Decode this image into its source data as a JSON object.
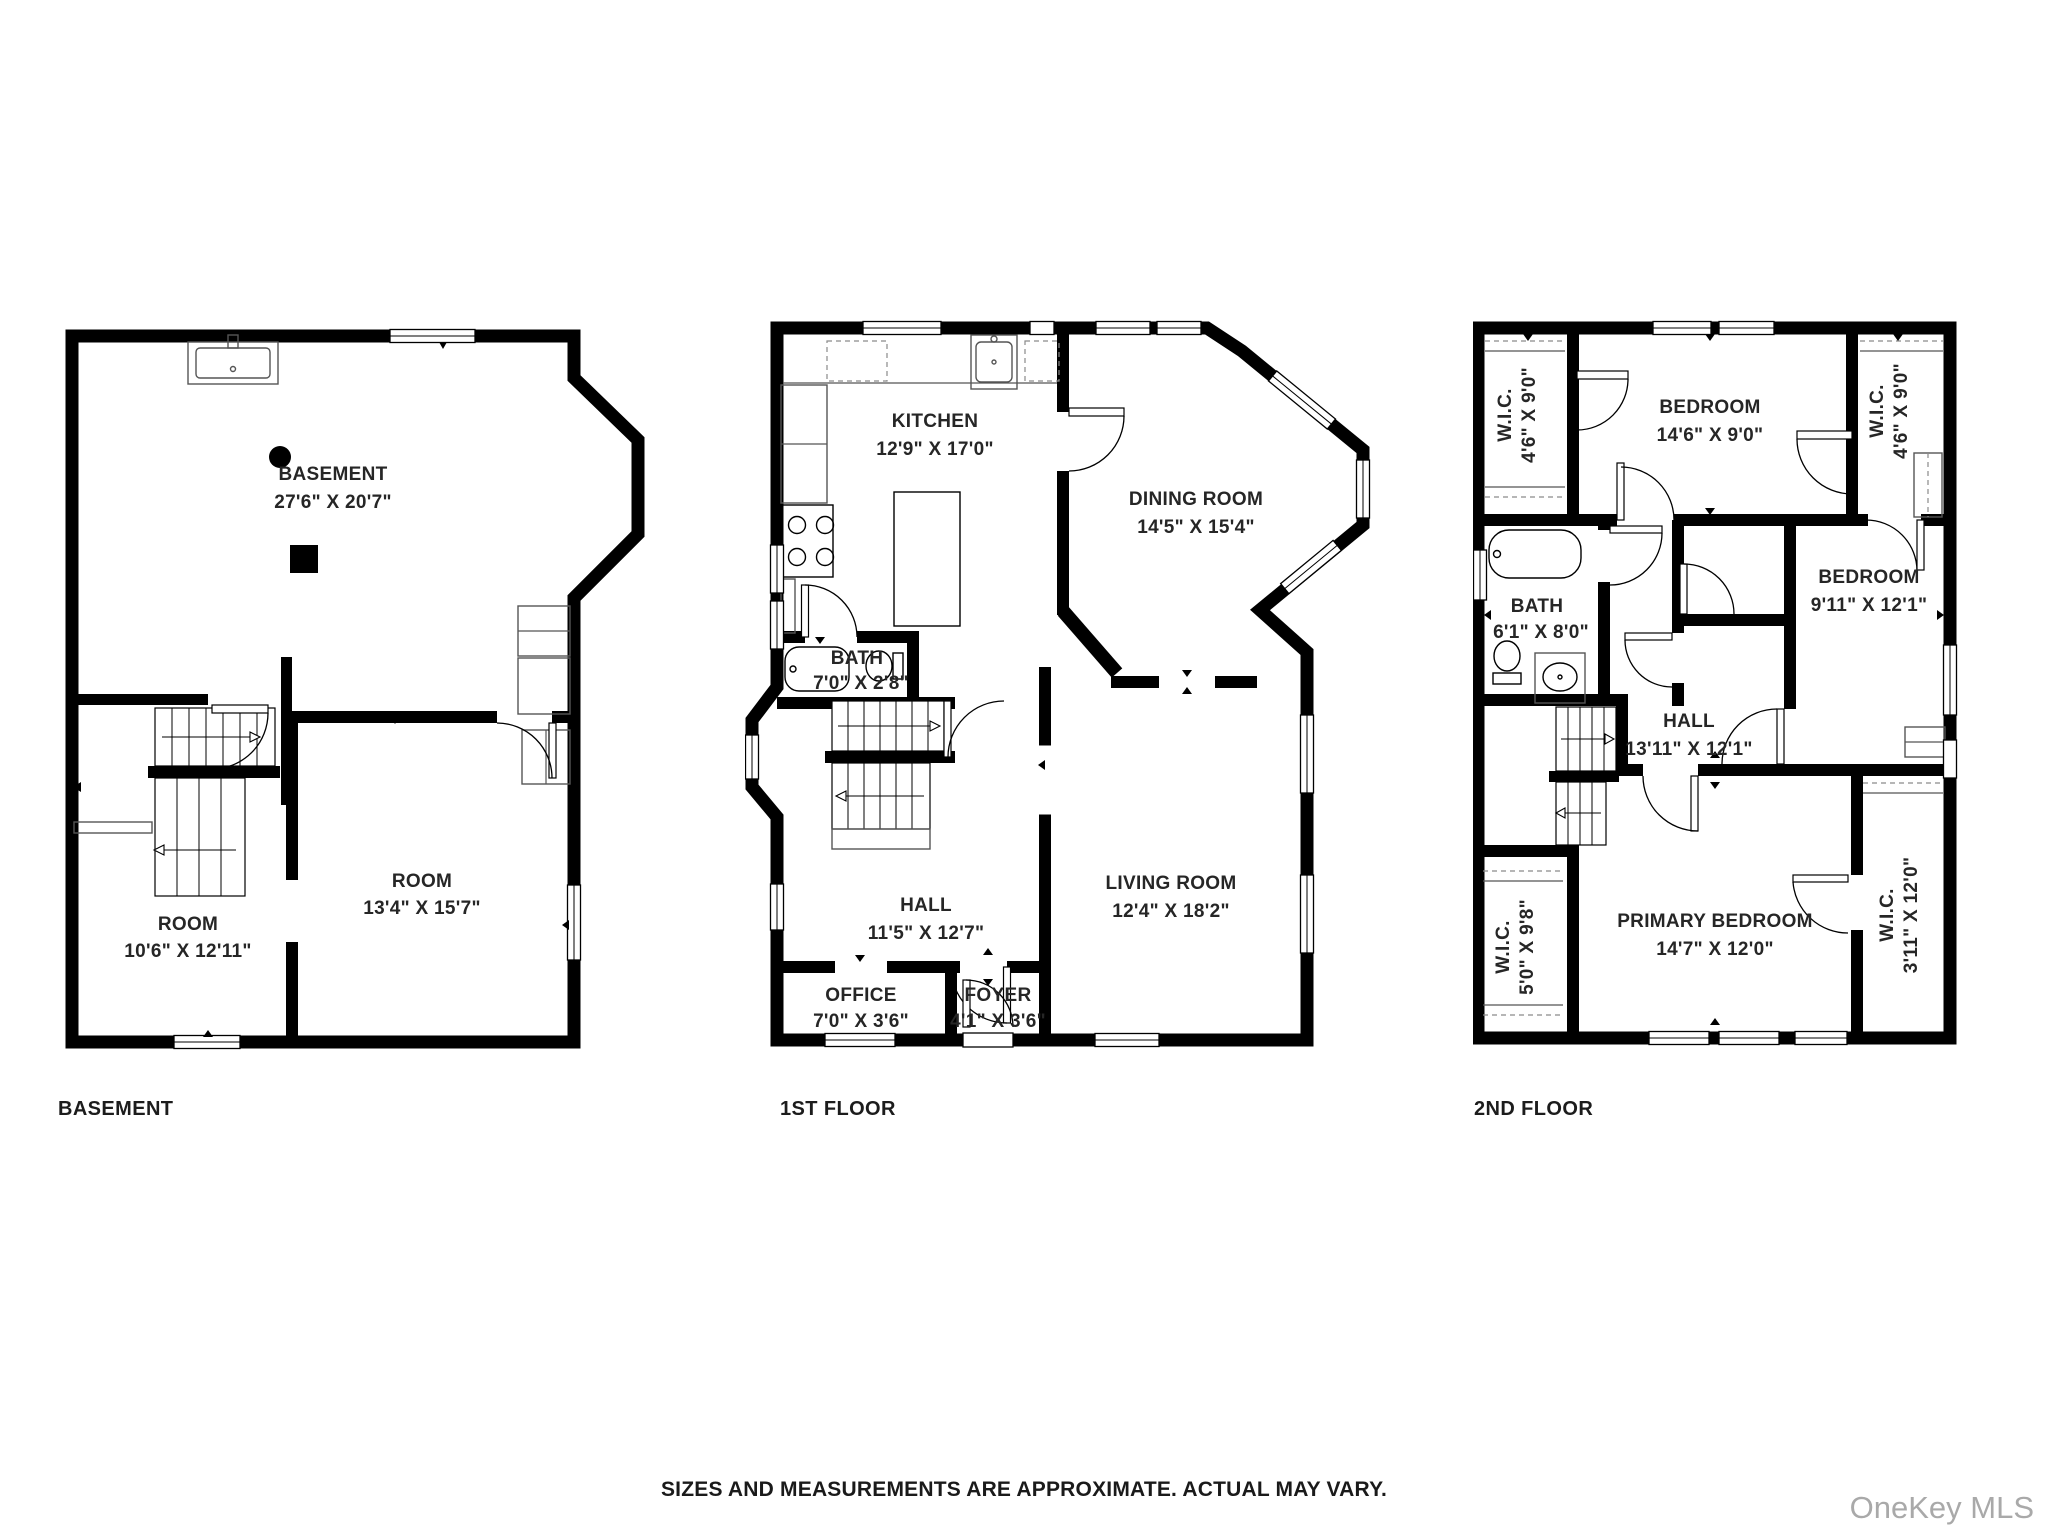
{
  "floors": [
    {
      "label": "BASEMENT",
      "rooms": [
        {
          "name": "BASEMENT",
          "dims": "27'6\" X 20'7\""
        },
        {
          "name": "ROOM",
          "dims": "10'6\" X 12'11\""
        },
        {
          "name": "ROOM",
          "dims": "13'4\" X 15'7\""
        }
      ]
    },
    {
      "label": "1ST FLOOR",
      "rooms": [
        {
          "name": "KITCHEN",
          "dims": "12'9\" X 17'0\""
        },
        {
          "name": "DINING ROOM",
          "dims": "14'5\" X 15'4\""
        },
        {
          "name": "BATH",
          "dims": "7'0\" X 2'8\""
        },
        {
          "name": "HALL",
          "dims": "11'5\" X 12'7\""
        },
        {
          "name": "LIVING ROOM",
          "dims": "12'4\" X 18'2\""
        },
        {
          "name": "OFFICE",
          "dims": "7'0\" X 3'6\""
        },
        {
          "name": "FOYER",
          "dims": "4'1\" X 3'6\""
        }
      ]
    },
    {
      "label": "2ND FLOOR",
      "rooms": [
        {
          "name": "W.I.C.",
          "dims": "4'6\" X 9'0\""
        },
        {
          "name": "BEDROOM",
          "dims": "14'6\" X 9'0\""
        },
        {
          "name": "W.I.C.",
          "dims": "4'6\" X 9'0\""
        },
        {
          "name": "BATH",
          "dims": "6'1\" X 8'0\""
        },
        {
          "name": "BEDROOM",
          "dims": "9'11\" X 12'1\""
        },
        {
          "name": "HALL",
          "dims": "13'11\" X 12'1\""
        },
        {
          "name": "W.I.C.",
          "dims": "5'0\" X 9'8\""
        },
        {
          "name": "PRIMARY BEDROOM",
          "dims": "14'7\" X 12'0\""
        },
        {
          "name": "W.I.C.",
          "dims": "3'11\" X 12'0\""
        }
      ]
    }
  ],
  "footer": {
    "disclaimer": "SIZES AND MEASUREMENTS ARE APPROXIMATE. ACTUAL MAY VARY.",
    "watermark": "OneKey MLS"
  },
  "colors": {
    "wall": "#000000",
    "background": "#ffffff",
    "watermark_gray": "#a9a9a9"
  }
}
